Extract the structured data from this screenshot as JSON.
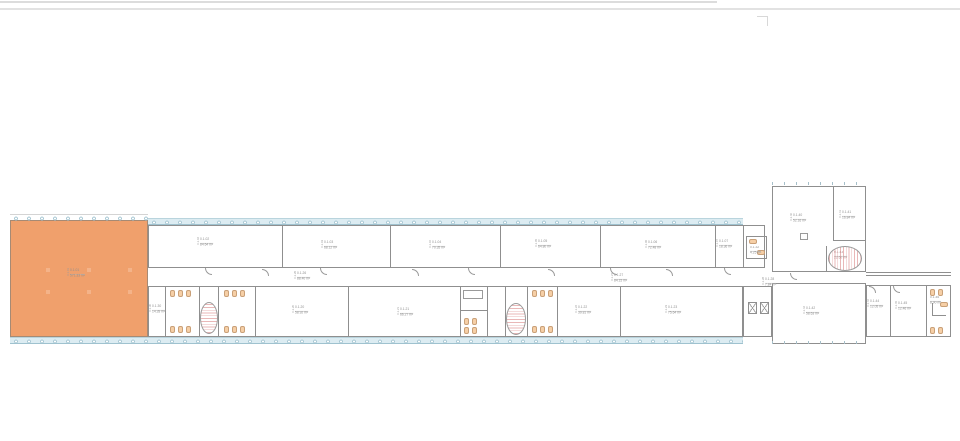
{
  "colors": {
    "highlight_room": "#F0A06C",
    "window_glass": "#DCECF2",
    "mullion": "#A9C8D4",
    "wall": "#8F8F8F",
    "fixture_fill": "#F6CFA6",
    "stair_hatch": "#E9B7B7",
    "label_text": "#8F8F8F"
  },
  "rooms": {
    "hall": {
      "id": "0.1.01",
      "area": "571.33 m²"
    },
    "upper": [
      {
        "id": "0.1.02",
        "area": "84.64 m²"
      },
      {
        "id": "0.1.03",
        "area": "68.12 m²"
      },
      {
        "id": "0.1.04",
        "area": "70.35 m²"
      },
      {
        "id": "0.1.05",
        "area": "64.80 m²"
      },
      {
        "id": "0.1.06",
        "area": "72.48 m²"
      },
      {
        "id": "0.1.07",
        "area": "18.36 m²"
      }
    ],
    "corridors": [
      {
        "id": "0.1.26",
        "area": "88.40 m²"
      },
      {
        "id": "0.1.27",
        "area": "84.15 m²"
      },
      {
        "id": "0.1.28",
        "area": "7.84 m²"
      }
    ],
    "lower": [
      {
        "id": "0.1.20",
        "area": "58.92 m²"
      },
      {
        "id": "0.1.21",
        "area": "66.27 m²"
      },
      {
        "id": "0.1.22",
        "area": "39.81 m²"
      },
      {
        "id": "0.1.23",
        "area": "75.64 m²"
      }
    ],
    "cores": [
      {
        "id": "0.1.30",
        "area": "14.28 m²"
      },
      {
        "id": "0.1.32",
        "area": "4.25 m²"
      }
    ],
    "stairs": [
      {
        "id": "0.1.43",
        "area": "22.60 m²"
      }
    ],
    "wing": [
      {
        "id": "0.1.40",
        "area": "52.16 m²"
      },
      {
        "id": "0.1.41",
        "area": "16.84 m²"
      },
      {
        "id": "0.1.42",
        "area": "58.63 m²"
      },
      {
        "id": "0.1.44",
        "area": "12.05 m²"
      },
      {
        "id": "0.1.45",
        "area": "12.46 m²"
      },
      {
        "id": "0.1.46",
        "area": "8.90 m²"
      }
    ]
  }
}
